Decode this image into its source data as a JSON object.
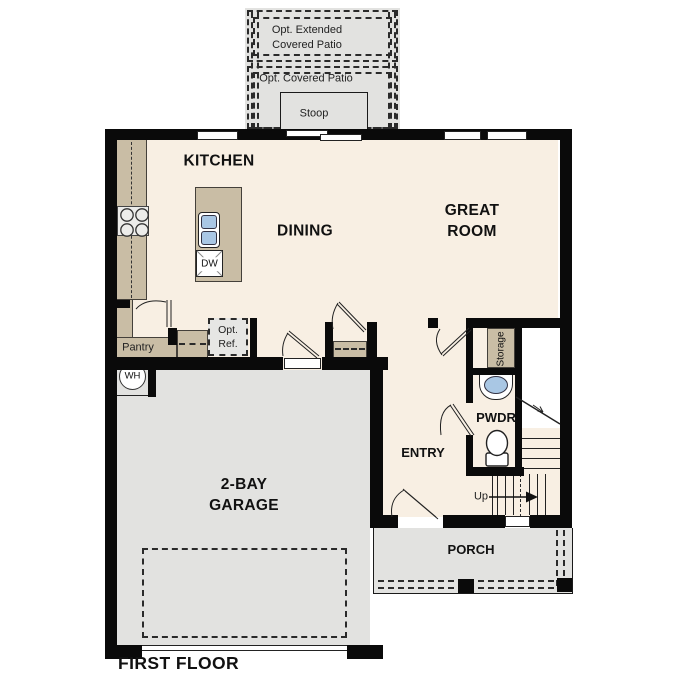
{
  "title": "FIRST FLOOR",
  "labels": {
    "kitchen": "KITCHEN",
    "dining": "DINING",
    "great_room": "GREAT ROOM",
    "garage": "2-BAY GARAGE",
    "entry": "ENTRY",
    "pwdr": "PWDR",
    "porch": "PORCH",
    "pantry": "Pantry",
    "storage": "Storage",
    "stoop": "Stoop",
    "opt_extended_patio": "Opt. Extended Covered Patio",
    "opt_covered_patio": "Opt. Covered Patio",
    "opt_ref": "Opt. Ref.",
    "up": "Up",
    "wh": "WH",
    "dw": "DW"
  },
  "colors": {
    "floor": "#f8efe3",
    "counter": "#c9bda5",
    "concrete": "#e2e2e0",
    "sink": "#a9c7e4",
    "wall": "#0a0a0a"
  }
}
